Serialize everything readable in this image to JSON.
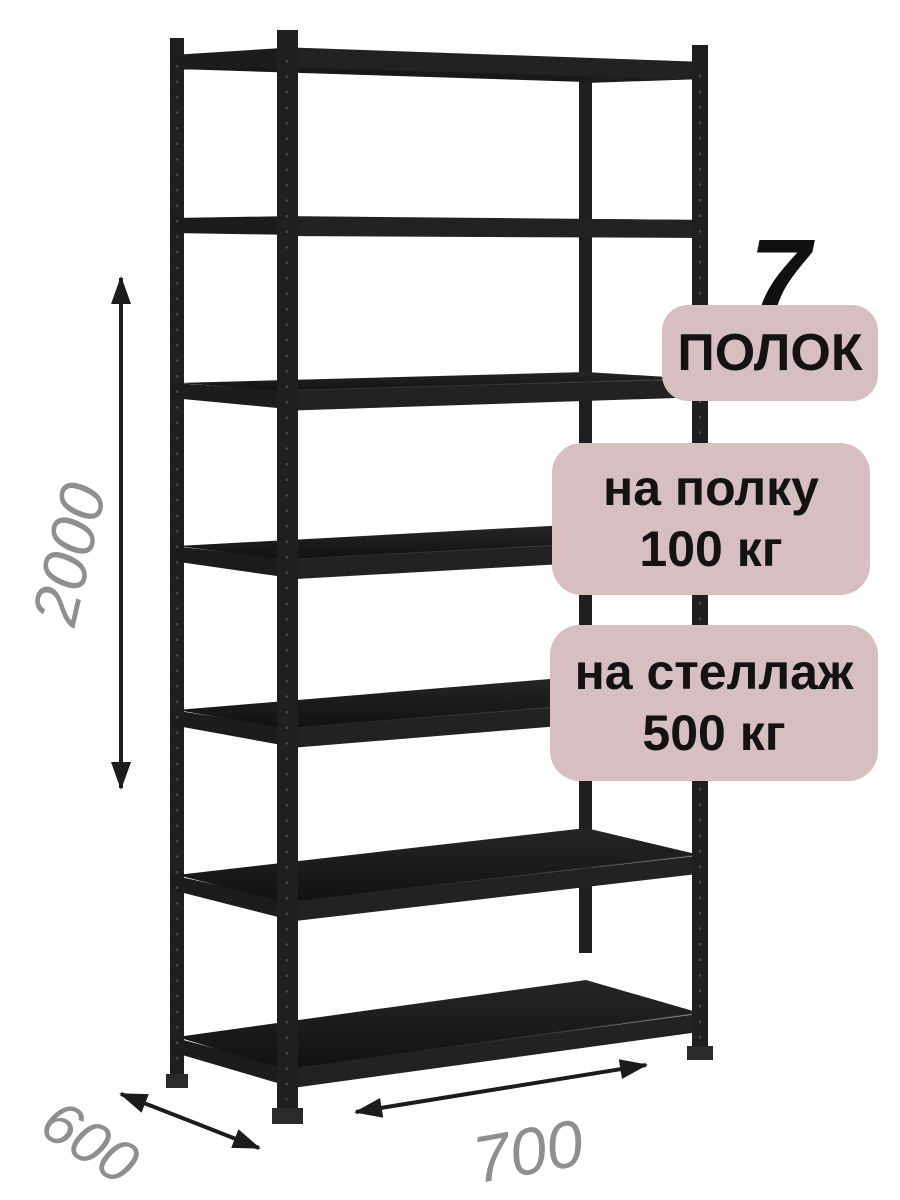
{
  "page": {
    "background": "#ffffff"
  },
  "rack": {
    "shelf_count": 7,
    "color": "#1f1f1f"
  },
  "badges": {
    "background_color": "#d6bec1",
    "text_color": "#131313",
    "shelf_count": {
      "number": "7",
      "label": "ПОЛОК"
    },
    "shelf_load": {
      "line1": "на полку",
      "line2": "100 кг"
    },
    "rack_load": {
      "line1": "на стеллаж",
      "line2": "500 кг"
    }
  },
  "dimensions": {
    "text_color": "#8f8f8f",
    "arrow_color": "#1c1c1c",
    "height": "2000",
    "depth": "600",
    "width": "700"
  }
}
